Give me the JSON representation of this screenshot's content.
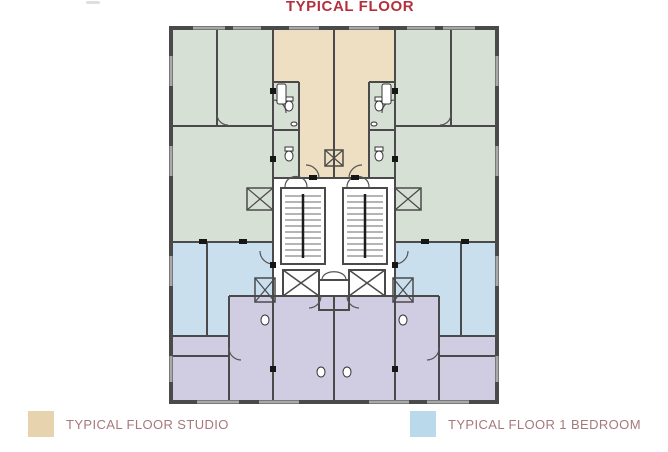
{
  "title": {
    "text": "TYPICAL FLOOR"
  },
  "legend": {
    "items": [
      {
        "label": "TYPICAL FLOOR STUDIO"
      },
      {
        "label": "TYPICAL FLOOR 1 BEDROOM"
      }
    ]
  },
  "colors": {
    "title": "#b5303c",
    "legend_text": "#a5797c",
    "wall": "#4a4a4a",
    "studio_fill": "#eedfc3",
    "one_bedroom_fill": "#c9dfee",
    "green_fill": "#d7e0d5",
    "lavender_fill": "#d0cde3",
    "shaft_cyan": "#cfe7f1",
    "swatch_studio": "#e7d4ae",
    "swatch_one_bedroom": "#badaec"
  }
}
